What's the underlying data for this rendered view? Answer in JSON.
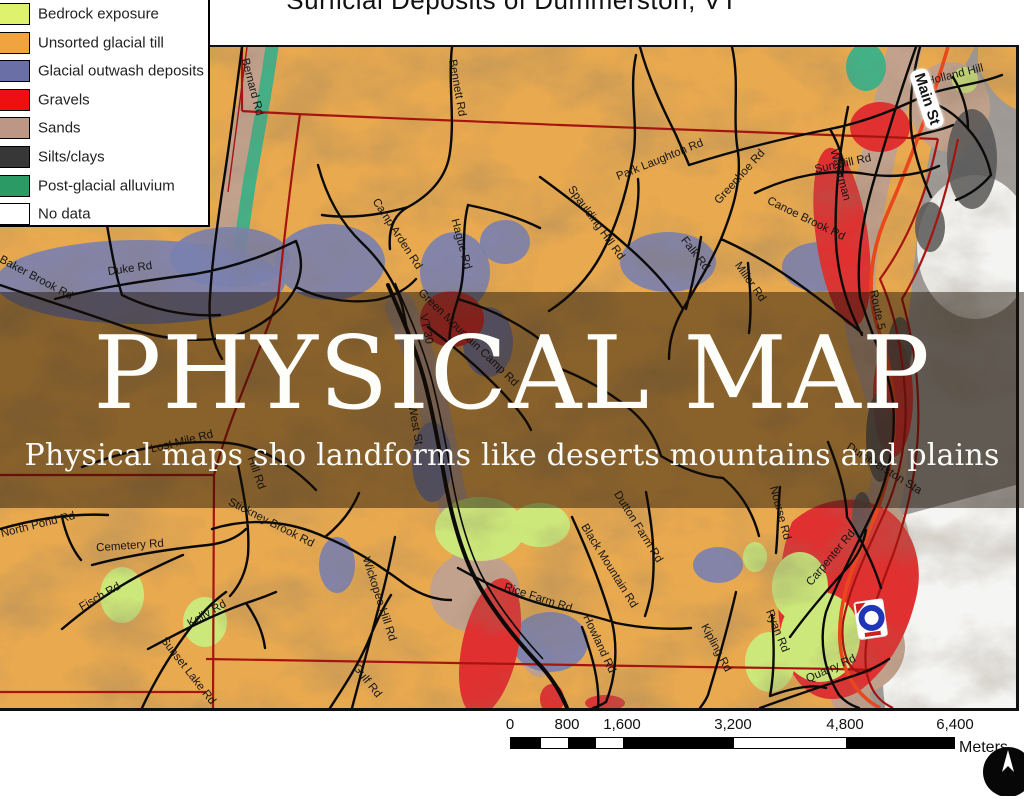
{
  "title": "Surficial Deposits of Dummerston, VT",
  "overlay": {
    "heading": "PHYSICAL MAP",
    "subheading": "Physical maps sho landforms like deserts mountains and plains"
  },
  "legend": {
    "items": [
      {
        "label": "Bedrock exposure",
        "color": "#def26d"
      },
      {
        "label": "Unsorted glacial till",
        "color": "#f0a43f"
      },
      {
        "label": "Glacial outwash deposits",
        "color": "#6a70a6"
      },
      {
        "label": "Gravels",
        "color": "#ed0f12"
      },
      {
        "label": "Sands",
        "color": "#bc9786"
      },
      {
        "label": "Silts/clays",
        "color": "#373737"
      },
      {
        "label": "Post-glacial alluvium",
        "color": "#2b9a64"
      },
      {
        "label": "No data",
        "color": "#ffffff"
      }
    ]
  },
  "map": {
    "palette": {
      "till": "#e8a94f",
      "outside_gray": "#a09c98",
      "no_data": "#f4f4f2",
      "sands": "#c2a28d",
      "alluvium": "#44b086",
      "outwash": "#7b81b0",
      "gravel": "#e03030",
      "bedrock": "#cce87a",
      "silts": "#555555",
      "boundary_red": "#a61410",
      "highway_red": "#e8481c",
      "road_black": "#0a0a0a"
    },
    "road_labels": [
      {
        "text": "Bernard Rd",
        "x": 252,
        "y": 40,
        "rot": 75
      },
      {
        "text": "Holland Hill",
        "x": 955,
        "y": 28,
        "rot": -14
      },
      {
        "text": "Sun Hill Rd",
        "x": 843,
        "y": 117,
        "rot": -12
      },
      {
        "text": "Park Laughton Rd",
        "x": 660,
        "y": 113,
        "rot": -22
      },
      {
        "text": "Greenhoe Rd",
        "x": 740,
        "y": 130,
        "rot": -48
      },
      {
        "text": "Canoe Brook Rd",
        "x": 806,
        "y": 172,
        "rot": 26
      },
      {
        "text": "Falk Rd",
        "x": 695,
        "y": 207,
        "rot": 52
      },
      {
        "text": "Miller Rd",
        "x": 750,
        "y": 235,
        "rot": 55
      },
      {
        "text": "Waterman",
        "x": 840,
        "y": 128,
        "rot": 75
      },
      {
        "text": "Main St",
        "x": 927,
        "y": 52,
        "rot": 72,
        "big": true
      },
      {
        "text": "Bennett Rd",
        "x": 457,
        "y": 41,
        "rot": 80
      },
      {
        "text": "Camp Arden Rd",
        "x": 397,
        "y": 187,
        "rot": 57
      },
      {
        "text": "Hague Rd",
        "x": 461,
        "y": 197,
        "rot": 75
      },
      {
        "text": "Spaulding Hill Rd",
        "x": 596,
        "y": 176,
        "rot": 54
      },
      {
        "text": "Baker Brook Rd",
        "x": 36,
        "y": 231,
        "rot": 28
      },
      {
        "text": "Duke Rd",
        "x": 130,
        "y": 222,
        "rot": -8
      },
      {
        "text": "Green Mountain Camp Rd",
        "x": 468,
        "y": 291,
        "rot": 44
      },
      {
        "text": "VT 30",
        "x": 426,
        "y": 282,
        "rot": 78
      },
      {
        "text": "West St",
        "x": 415,
        "y": 378,
        "rot": 80
      },
      {
        "text": "Lost Mile Rd",
        "x": 182,
        "y": 395,
        "rot": -14
      },
      {
        "text": "Hill Rd",
        "x": 256,
        "y": 426,
        "rot": 70
      },
      {
        "text": "Stickney Brook Rd",
        "x": 271,
        "y": 476,
        "rot": 27
      },
      {
        "text": "North Pond Rd",
        "x": 38,
        "y": 478,
        "rot": -14
      },
      {
        "text": "Cemetery Rd",
        "x": 130,
        "y": 499,
        "rot": -4
      },
      {
        "text": "Fisch Rd",
        "x": 100,
        "y": 550,
        "rot": -30
      },
      {
        "text": "Kelly Rd",
        "x": 207,
        "y": 567,
        "rot": -30
      },
      {
        "text": "Sunset Lake Rd",
        "x": 188,
        "y": 624,
        "rot": 52
      },
      {
        "text": "Wickopee Hill Rd",
        "x": 379,
        "y": 552,
        "rot": 72
      },
      {
        "text": "Gulf Rd",
        "x": 367,
        "y": 634,
        "rot": 52
      },
      {
        "text": "Rice Farm Rd",
        "x": 538,
        "y": 551,
        "rot": 18
      },
      {
        "text": "Black Mountain Rd",
        "x": 609,
        "y": 519,
        "rot": 58
      },
      {
        "text": "Dutton Farm Rd",
        "x": 638,
        "y": 480,
        "rot": 58
      },
      {
        "text": "Howland Rd",
        "x": 599,
        "y": 597,
        "rot": 65
      },
      {
        "text": "Kipling Rd",
        "x": 716,
        "y": 601,
        "rot": 62
      },
      {
        "text": "Carpenter Rd",
        "x": 831,
        "y": 511,
        "rot": -50
      },
      {
        "text": "Nourse Rd",
        "x": 780,
        "y": 466,
        "rot": 75
      },
      {
        "text": "Ryan Rd",
        "x": 777,
        "y": 584,
        "rot": 68
      },
      {
        "text": "Quarry Rd",
        "x": 831,
        "y": 622,
        "rot": -24
      },
      {
        "text": "Dummerston Sta",
        "x": 884,
        "y": 422,
        "rot": 32
      },
      {
        "text": "Route 5",
        "x": 877,
        "y": 263,
        "rot": 78
      }
    ]
  },
  "scalebar": {
    "ticks": [
      "0",
      "800",
      "1,600",
      "3,200",
      "4,800",
      "6,400"
    ],
    "unit": "Meters"
  }
}
